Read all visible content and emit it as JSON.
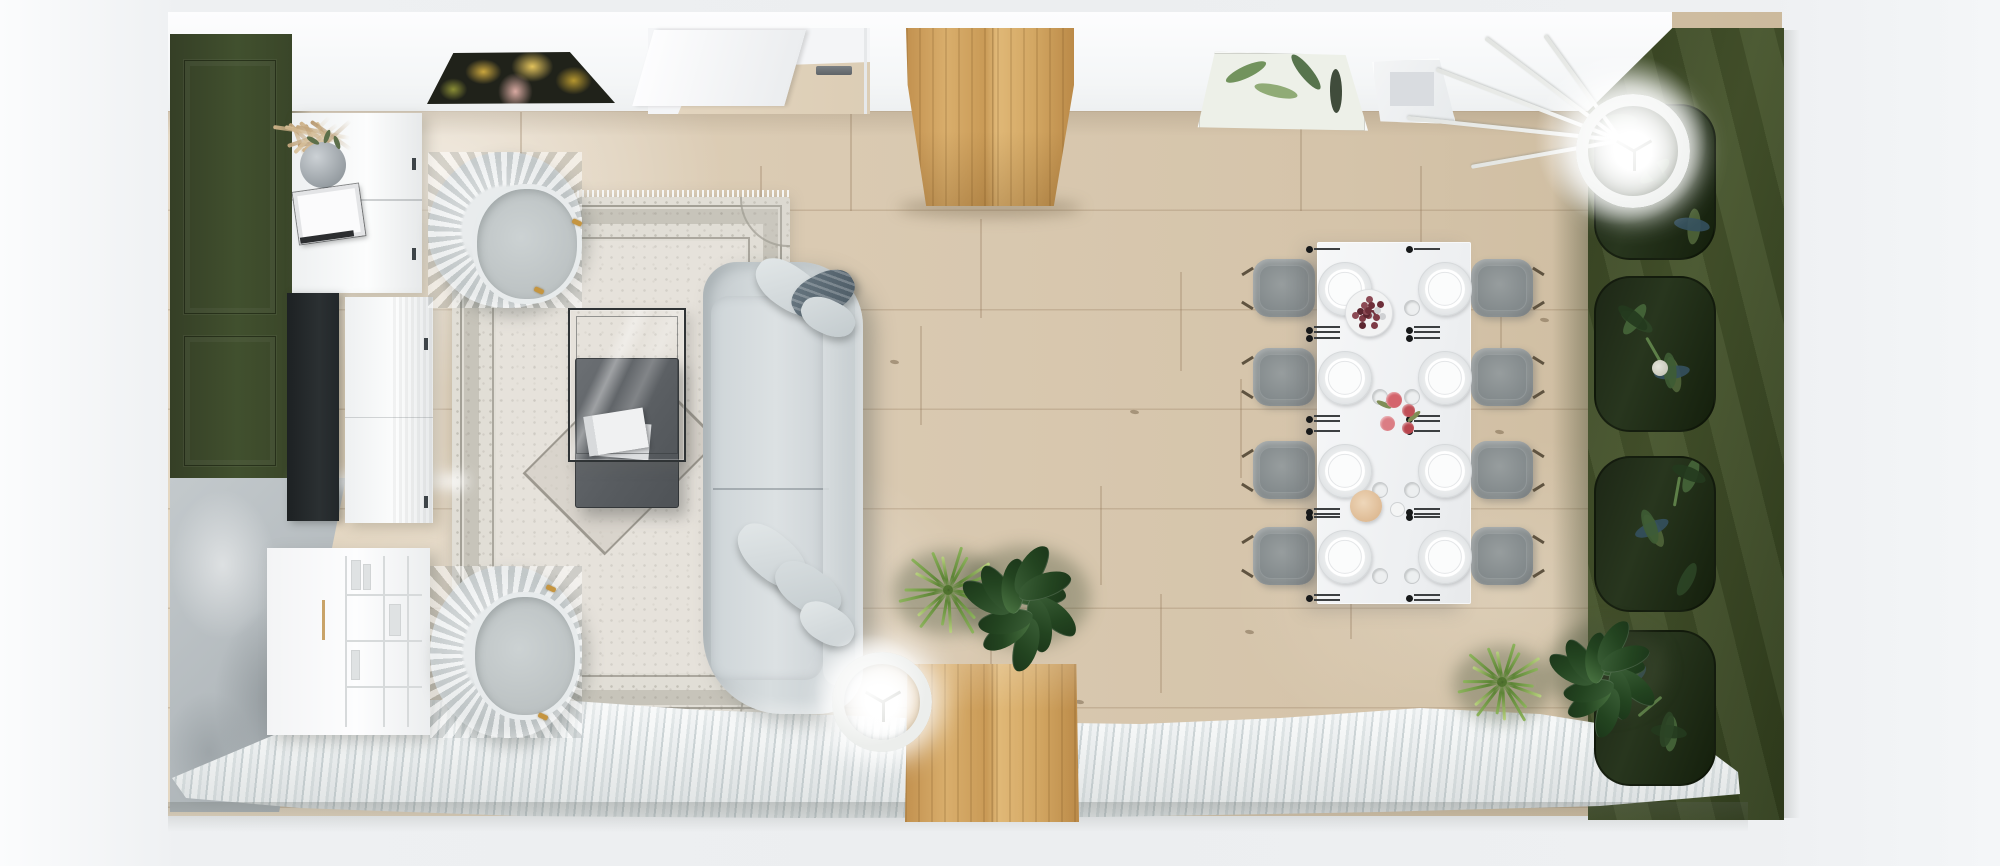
{
  "meta": {
    "description": "Top-down 3D render of a rectangular living and dining room: white top wall with two botanical prints and a door, dark olive panelled accent wall and concrete feature wall on the left with a TV and white cabinets, light oak plank floor, ornate grey rug with two scalloped armchairs, light grey sofa with cushions, glass and dark nesting coffee tables, oak closet and bench volumes, white 8-seat dining table with grey chairs and place settings, draped olive wall with botanical arch panels on the right, ring floor lamps, potted palms and rubber plants, and sheer white curtains along the bottom window wall."
  },
  "palette": {
    "canvas": "#eef0f2",
    "wall_white": "#f8f9fa",
    "green_left": "#3c4728",
    "green_right": "#425029",
    "concrete": "#b7bdc0",
    "floor_mid": "#d8c8b0",
    "floor_light": "#e8decd",
    "plank_line": "#a98f6b",
    "rug_base": "#e1ded6",
    "rug_pattern": "#a5a199",
    "sofa": "#cdd4d6",
    "pillow_dark": "#5e6d78",
    "armchair": "#d6dadb",
    "dining_chair": "#8e9495",
    "table_white": "#f4f5f6",
    "wood": "#cf9f5e",
    "wood_dark": "#b4854a",
    "wood_light": "#e3bd80",
    "palm_green": "#7fa24c",
    "plant_dark": "#2c4a29",
    "botanical_panel": "#222c19",
    "curtain": "#e9eced",
    "curtain_shade": "#c7cfd1",
    "tv": "#24292b",
    "glass_frame": "#303436",
    "dark_table": "#5e6266",
    "gold": "#c59540",
    "berry": "#6e2f3a",
    "flower": "#cf5f68",
    "bread": "#e2c4a4",
    "lamp": "#ededeb",
    "cutlery_metal": "#3c3f41"
  },
  "scene": {
    "floor": {
      "origin": [
        168,
        12
      ],
      "joints": [
        [
          520,
          112
        ],
        [
          850,
          112
        ],
        [
          1300,
          112
        ],
        [
          760,
          166
        ],
        [
          1420,
          166
        ],
        [
          980,
          219
        ],
        [
          660,
          272
        ],
        [
          1180,
          272
        ],
        [
          1500,
          272
        ],
        [
          920,
          326
        ],
        [
          1240,
          379
        ],
        [
          700,
          433
        ],
        [
          640,
          433
        ],
        [
          1100,
          486
        ],
        [
          560,
          540
        ],
        [
          1350,
          540
        ],
        [
          1160,
          594
        ],
        [
          760,
          594
        ],
        [
          480,
          594
        ],
        [
          990,
          647
        ]
      ],
      "knots": [
        [
          705,
          468
        ],
        [
          640,
          292
        ],
        [
          1075,
          700
        ],
        [
          820,
          624
        ],
        [
          1310,
          120
        ],
        [
          560,
          96
        ],
        [
          1495,
          430
        ],
        [
          1540,
          318
        ],
        [
          1048,
          176
        ],
        [
          1245,
          630
        ],
        [
          890,
          360
        ],
        [
          1395,
          520
        ],
        [
          1130,
          410
        ]
      ]
    },
    "pampas": {
      "x": 246,
      "y": 74,
      "blades": 15,
      "colors": [
        "#cdb188",
        "#b89a72",
        "#d9c29c",
        "#c2a57c"
      ]
    },
    "vase_sprigs": [
      [
        6,
        -4,
        30
      ],
      [
        20,
        -8,
        110
      ],
      [
        30,
        -2,
        70
      ]
    ],
    "armchairs": [
      {
        "x": 428,
        "y": 152,
        "w": 154,
        "h": 156,
        "seat": [
          44,
          32,
          100,
          110
        ],
        "feet": [
          [
            144,
            68
          ],
          [
            106,
            136
          ]
        ]
      },
      {
        "x": 430,
        "y": 566,
        "w": 152,
        "h": 172,
        "seat": [
          40,
          26,
          100,
          118
        ],
        "feet": [
          [
            116,
            20
          ],
          [
            108,
            148
          ]
        ]
      }
    ],
    "sofa_pillows": [
      [
        752,
        266,
        74,
        42,
        34,
        "light"
      ],
      [
        790,
        274,
        66,
        40,
        -28,
        "dark"
      ],
      [
        800,
        300,
        56,
        34,
        26,
        "light2"
      ],
      [
        732,
        534,
        80,
        44,
        40,
        "light"
      ],
      [
        772,
        568,
        72,
        42,
        36,
        "light2"
      ],
      [
        798,
        606,
        58,
        36,
        30,
        "light"
      ]
    ],
    "dining": {
      "rows_y": [
        288,
        377,
        470,
        556
      ],
      "plate_cols_x": [
        1344,
        1444
      ],
      "plate_d": 52,
      "chair_cols_x": [
        1284,
        1502
      ],
      "chair_size": [
        62,
        58
      ],
      "berry": {
        "cx": 1368,
        "cy": 312,
        "plate_d": 46,
        "count": 18,
        "colors": [
          "#6e2f3a",
          "#7e3b46",
          "#8c4a55",
          "#cfd1d3",
          "#5c2630"
        ]
      },
      "flowers": {
        "x": 1376,
        "y": 388,
        "blossoms": [
          [
            10,
            4,
            16,
            "#d4646c"
          ],
          [
            26,
            16,
            13,
            "#c04f57"
          ],
          [
            4,
            28,
            15,
            "#db7d84"
          ],
          [
            26,
            34,
            12,
            "#b8454d"
          ]
        ],
        "leaves": [
          [
            0,
            14,
            25
          ],
          [
            30,
            26,
            -40
          ]
        ]
      }
    },
    "right_wall_arches": {
      "x": 1594,
      "w": 118,
      "h": 152,
      "ys": [
        104,
        276,
        456,
        630
      ],
      "rose_index": 1,
      "leaf_colors": [
        "#3e5c34",
        "#2c4526",
        "#50653a",
        "#46663a",
        "#34505e",
        "#243a1e"
      ]
    },
    "picture_leaves": {
      "colors": [
        "#64884e",
        "#85a369",
        "#46663c",
        "#2c3a28"
      ]
    },
    "lamps": {
      "corner": {
        "cx": 1621,
        "cy": 139,
        "d": 90,
        "glow_d": 230,
        "legs": [
          [
            186,
            215
          ],
          [
            201,
            198
          ],
          [
            217,
            170
          ],
          [
            234,
            130
          ],
          [
            170,
            152
          ]
        ]
      },
      "sofa": {
        "cx": 870,
        "cy": 690,
        "d": 76,
        "glow_d": 150,
        "legs": []
      }
    },
    "plants": [
      [
        "palm",
        948,
        590,
        1.0
      ],
      [
        "rubber",
        1024,
        594,
        1.2
      ],
      [
        "palm",
        1502,
        682,
        0.9
      ],
      [
        "rubber",
        1606,
        666,
        1.1
      ]
    ],
    "plant_colors": {
      "frond_light": "#8db45c",
      "frond_dark": "#5d8436",
      "leaf_hi": "#4f7a46",
      "leaf_lo": "#1b3519",
      "leaf_mid": "#234420"
    }
  }
}
